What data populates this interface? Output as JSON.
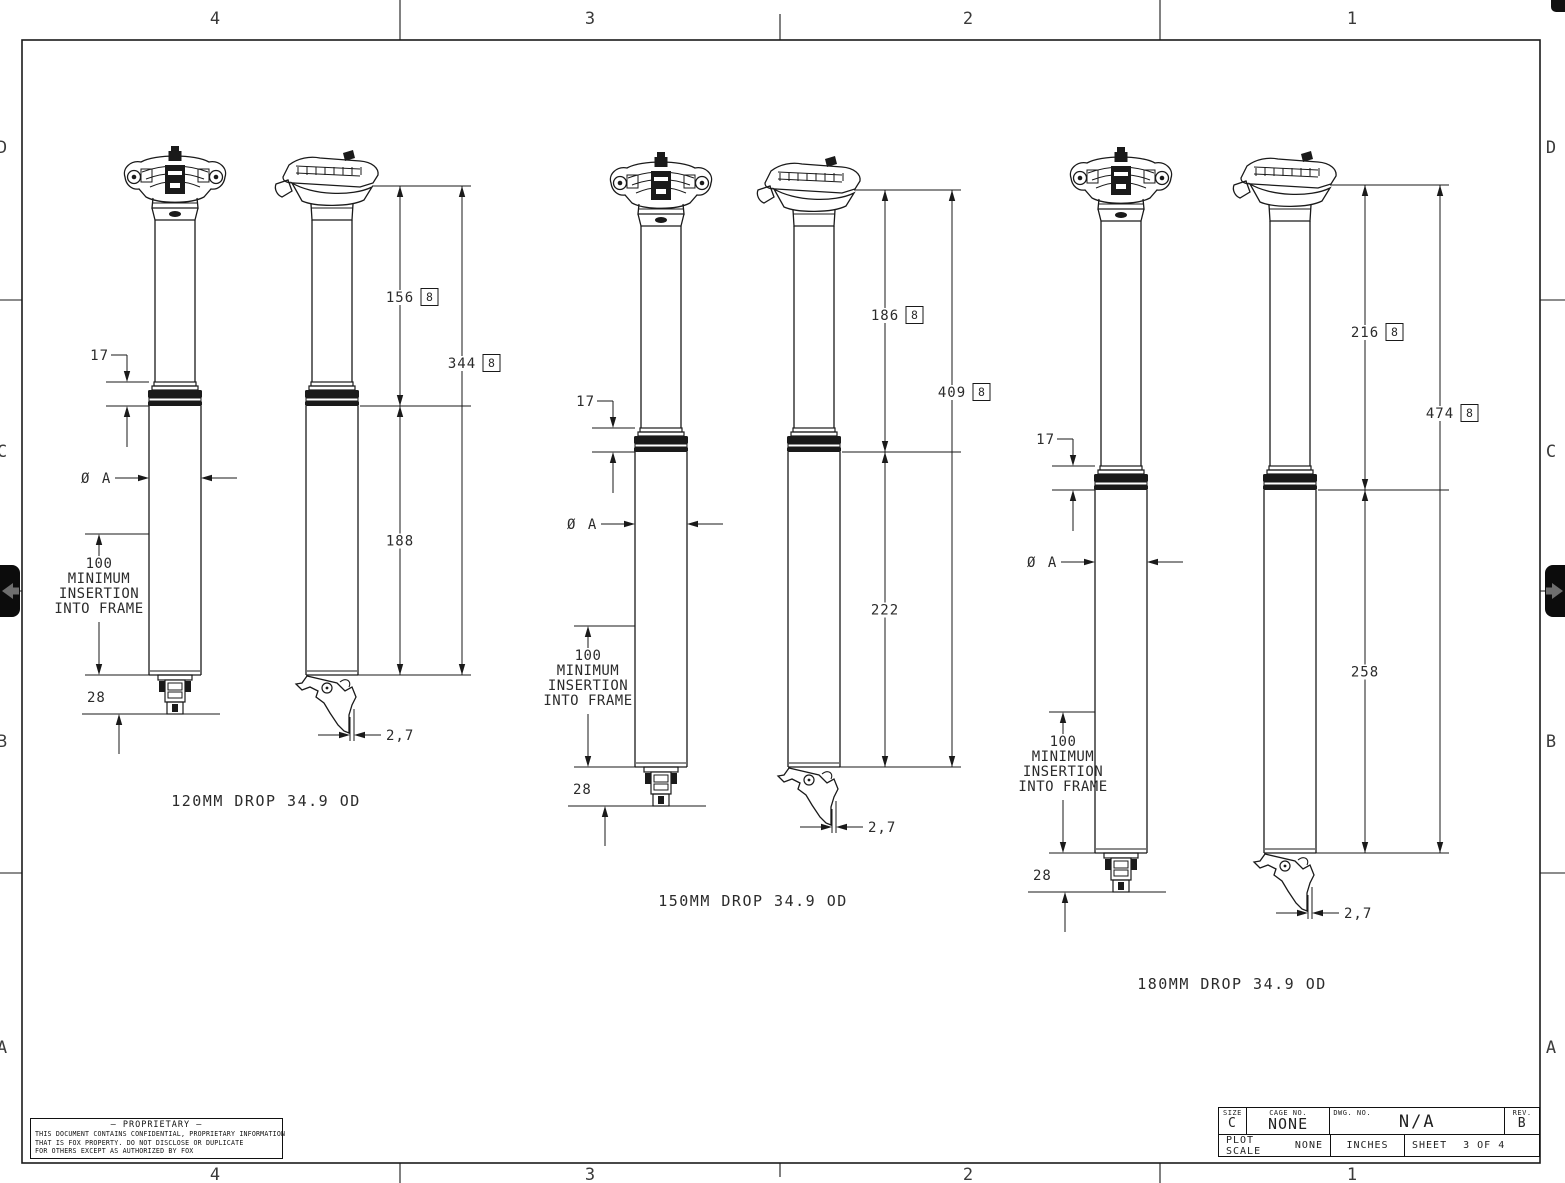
{
  "sheet": {
    "zone_columns": [
      "4",
      "3",
      "2",
      "1"
    ],
    "zone_rows": [
      "D",
      "C",
      "B",
      "A"
    ]
  },
  "groups": [
    {
      "label": "120MM DROP  34.9 OD",
      "upper_length": "156",
      "total_length": "344",
      "lower_length": "188",
      "collar_height": "17",
      "diameter_label": "Ø A",
      "insertion_note": [
        "100",
        "MINIMUM",
        "INSERTION",
        "INTO FRAME"
      ],
      "tip_length": "28",
      "offset": "2,7",
      "flag": "8"
    },
    {
      "label": "150MM DROP  34.9 OD",
      "upper_length": "186",
      "total_length": "409",
      "lower_length": "222",
      "collar_height": "17",
      "diameter_label": "Ø A",
      "insertion_note": [
        "100",
        "MINIMUM",
        "INSERTION",
        "INTO FRAME"
      ],
      "tip_length": "28",
      "offset": "2,7",
      "flag": "8"
    },
    {
      "label": "180MM DROP  34.9 OD",
      "upper_length": "216",
      "total_length": "474",
      "lower_length": "258",
      "collar_height": "17",
      "diameter_label": "Ø A",
      "insertion_note": [
        "100",
        "MINIMUM",
        "INSERTION",
        "INTO FRAME"
      ],
      "tip_length": "28",
      "offset": "2,7",
      "flag": "8"
    }
  ],
  "title_block": {
    "size_label": "SIZE",
    "size_value": "C",
    "cage_label": "CAGE NO.",
    "cage_value": "NONE",
    "dwg_label": "DWG. NO.",
    "dwg_value": "N/A",
    "rev_label": "REV.",
    "rev_value": "B",
    "plot_scale_label": "PLOT SCALE",
    "plot_scale_value": "NONE",
    "units_value": "INCHES",
    "sheet_label": "SHEET",
    "sheet_value": "3 OF 4"
  },
  "proprietary": {
    "title": "— PROPRIETARY —",
    "lines": [
      "THIS DOCUMENT CONTAINS CONFIDENTIAL, PROPRIETARY INFORMATION",
      "THAT IS FOX PROPERTY.  DO NOT DISCLOSE OR DUPLICATE",
      "FOR OTHERS EXCEPT AS AUTHORIZED BY FOX"
    ]
  },
  "colors": {
    "line": "#1a1a1a",
    "text": "#2b2b2b",
    "zone_text": "#3a3a3a",
    "tab_bg": "#0c0c0c",
    "tab_arrow": "#6e6e6e"
  }
}
